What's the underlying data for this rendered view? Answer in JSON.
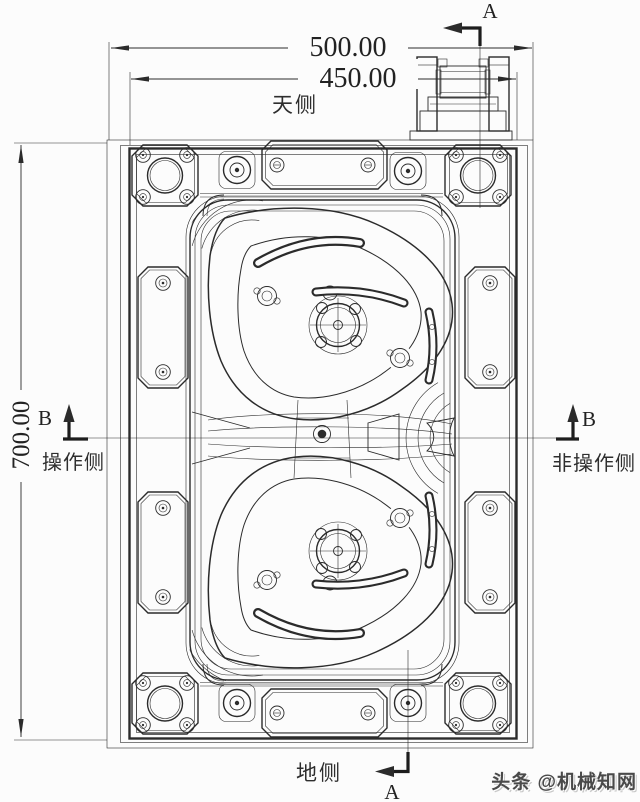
{
  "drawing": {
    "dimensions": {
      "outer_width": "500.00",
      "inner_width": "450.00",
      "height": "700.00"
    },
    "side_labels": {
      "top": "天侧",
      "bottom": "地侧",
      "left": "操作侧",
      "right": "非操作侧"
    },
    "section_labels": {
      "a": "A",
      "b": "B"
    },
    "watermark": {
      "text": "头条 @机械知网"
    },
    "colors": {
      "line": "#2b2b2b",
      "background": "#fcfcfc",
      "watermark": "#4a4a4a"
    }
  }
}
